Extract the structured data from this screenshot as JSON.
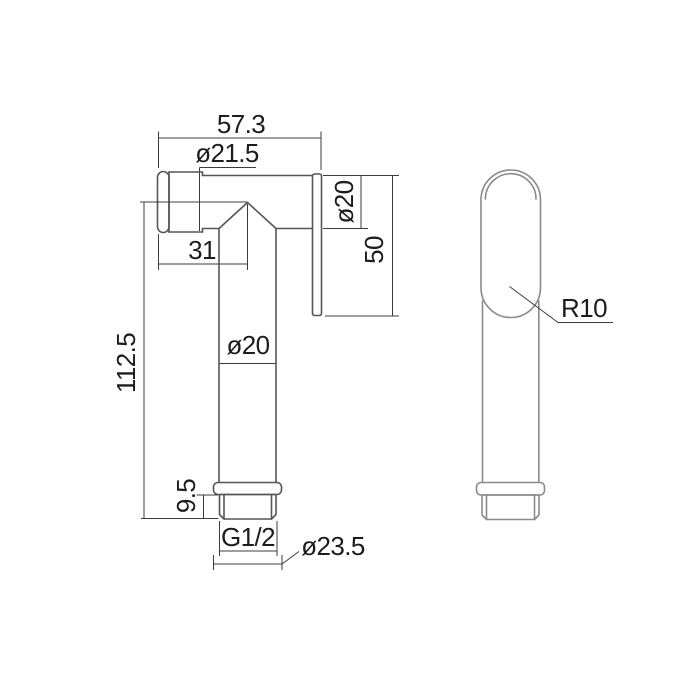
{
  "page": {
    "background": "#ffffff"
  },
  "drawing": {
    "colors": {
      "object_line_side": "#565656",
      "object_line_front": "#8a8a8a",
      "dimension_line": "#3c3c3c",
      "text": "#1d1d1d"
    },
    "side_view": {
      "dims": {
        "overall_length": "57.3",
        "head_diameter": "ø21.5",
        "outlet_diameter": "ø20",
        "back_plate_length": "50",
        "nozzle_offset": "31",
        "overall_height": "112.5",
        "body_diameter": "ø20",
        "thread_length": "9.5",
        "thread_spec": "G1/2",
        "collar_diameter": "ø23.5"
      }
    },
    "front_view": {
      "dims": {
        "head_radius": "R10"
      }
    }
  }
}
